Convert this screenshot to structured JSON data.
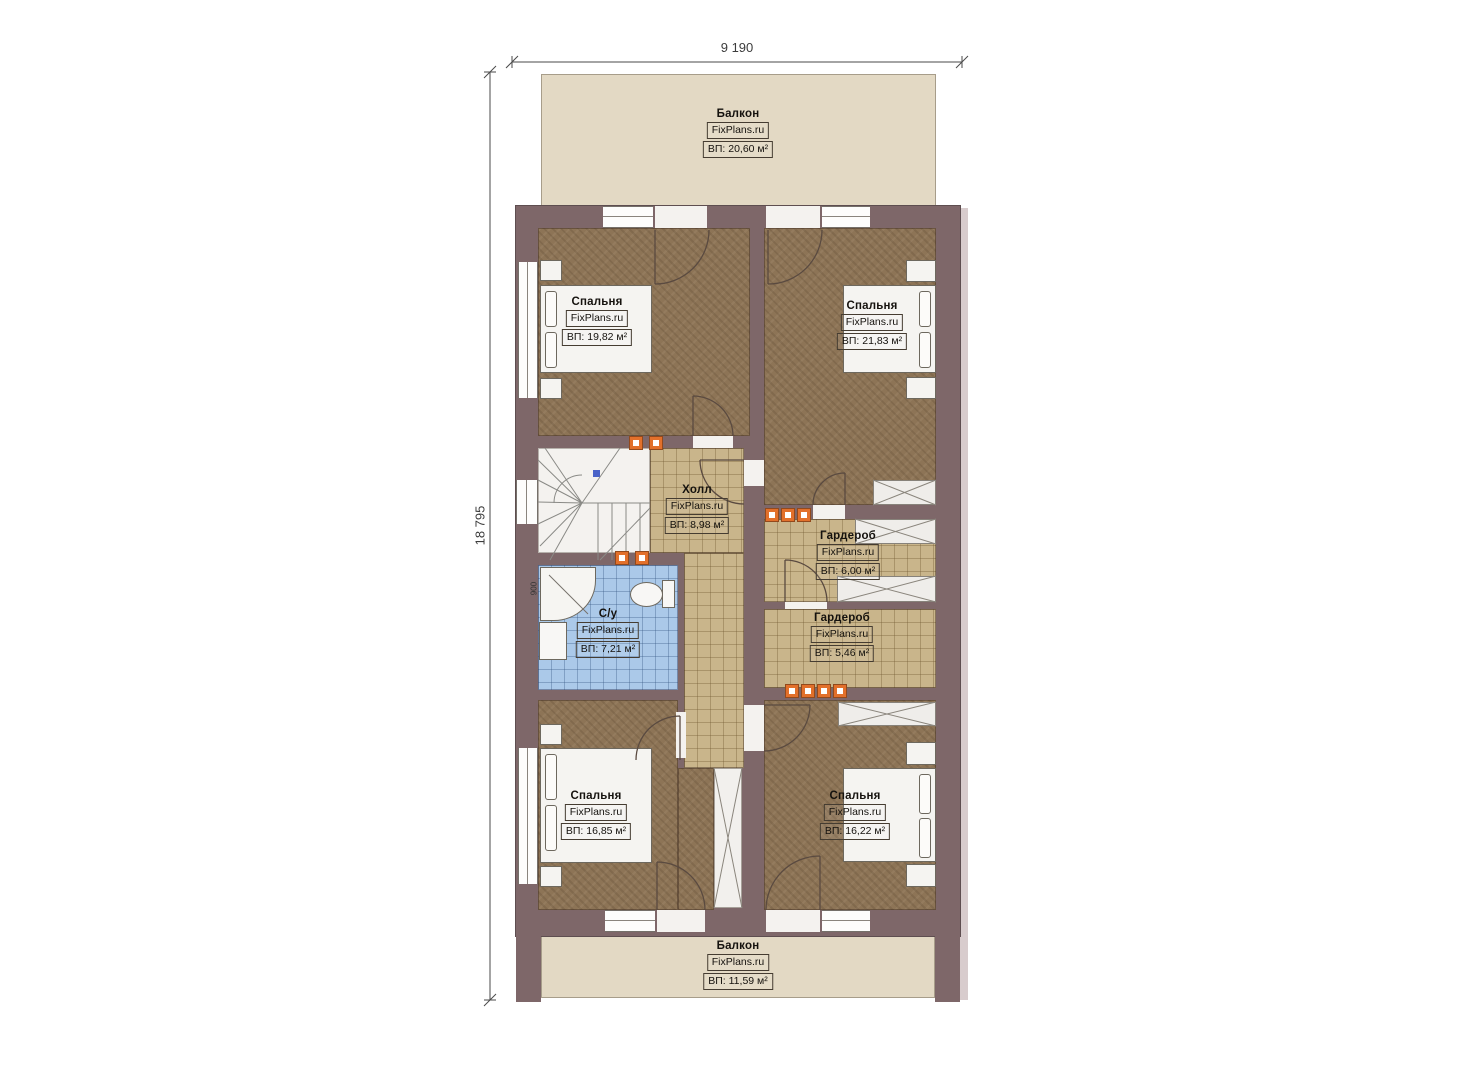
{
  "brand": "FixPlans.ru",
  "dimensions": {
    "width_label": "9 190",
    "height_label": "18 795"
  },
  "rooms": {
    "balcony_top": {
      "name": "Балкон",
      "brand": "FixPlans.ru",
      "area": "ВП: 20,60 м²"
    },
    "bedroom_tl": {
      "name": "Спальня",
      "brand": "FixPlans.ru",
      "area": "ВП: 19,82 м²"
    },
    "bedroom_tr": {
      "name": "Спальня",
      "brand": "FixPlans.ru",
      "area": "ВП: 21,83 м²"
    },
    "hall": {
      "name": "Холл",
      "brand": "FixPlans.ru",
      "area": "ВП: 8,98 м²"
    },
    "wardrobe_1": {
      "name": "Гардероб",
      "brand": "FixPlans.ru",
      "area": "ВП: 6,00 м²"
    },
    "wardrobe_2": {
      "name": "Гардероб",
      "brand": "FixPlans.ru",
      "area": "ВП: 5,46 м²"
    },
    "bathroom": {
      "name": "С/у",
      "brand": "FixPlans.ru",
      "area": "ВП: 7,21 м²"
    },
    "bedroom_bl": {
      "name": "Спальня",
      "brand": "FixPlans.ru",
      "area": "ВП: 16,85 м²"
    },
    "bedroom_br": {
      "name": "Спальня",
      "brand": "FixPlans.ru",
      "area": "ВП: 16,22 м²"
    },
    "balcony_bottom": {
      "name": "Балкон",
      "brand": "FixPlans.ru",
      "area": "ВП: 11,59 м²"
    }
  },
  "annotations": {
    "shower_dimension": "900"
  },
  "colors": {
    "wall": "#7e6769",
    "bedroom_floor": "#8d7456",
    "tile_floor": "#c9b58b",
    "bathroom_floor": "#abc9e9",
    "balcony_floor": "#e3d9c4",
    "vent_marker": "#e2702b",
    "stair_fill": "#f4f2ef"
  }
}
